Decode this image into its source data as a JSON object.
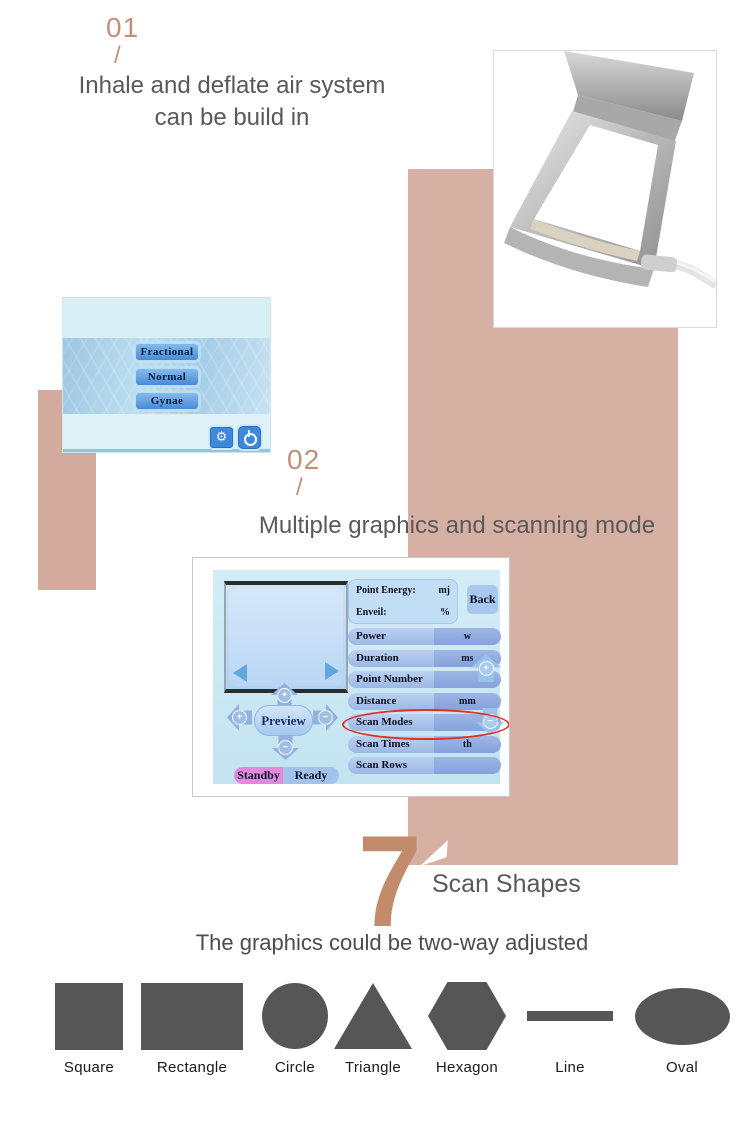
{
  "colors": {
    "accent_tan": "#d6b1a3",
    "accent_tan_left": "#d2ab9d",
    "number_tan": "#c2907a",
    "seven_tan": "#c28c6c",
    "heading_gray": "#595959",
    "shape_gray": "#565656",
    "highlight_red": "#e23023",
    "standby_pink": "#e18ade",
    "ui_blue": "#3e87da"
  },
  "section_01": {
    "number": "01",
    "slash": "/",
    "heading_line1": "Inhale and deflate air system",
    "heading_line2": "can be build in"
  },
  "device_screen": {
    "buttons": [
      "Fractional",
      "Normal",
      "Gynae"
    ],
    "gear_icon_glyph": "⚙",
    "icons": [
      "gear-icon",
      "power-icon"
    ]
  },
  "section_02": {
    "number": "02",
    "slash": "/",
    "heading": "Multiple graphics and scanning mode"
  },
  "control_screen": {
    "info_box": {
      "line1_label": "Point Energy:",
      "line1_unit": "mj",
      "line2_label": "Enveil:",
      "line2_unit": "%"
    },
    "back_button": "Back",
    "params": [
      {
        "label": "Power",
        "unit": "w"
      },
      {
        "label": "Duration",
        "unit": "ms"
      },
      {
        "label": "Point Number",
        "unit": ""
      },
      {
        "label": "Distance",
        "unit": "mm"
      },
      {
        "label": "Scan Modes",
        "unit": ""
      },
      {
        "label": "Scan Times",
        "unit": "th"
      },
      {
        "label": "Scan Rows",
        "unit": ""
      }
    ],
    "highlighted_param": "Scan Modes",
    "preview_button": "Preview",
    "standby_button": "Standby",
    "ready_button": "Ready",
    "plus": "+",
    "minus": "−"
  },
  "section_07": {
    "number": "7",
    "heading": "Scan Shapes",
    "subheading": "The graphics could be two-way adjusted"
  },
  "shapes": [
    {
      "type": "square",
      "label": "Square"
    },
    {
      "type": "rectangle",
      "label": "Rectangle"
    },
    {
      "type": "circle",
      "label": "Circle"
    },
    {
      "type": "triangle",
      "label": "Triangle"
    },
    {
      "type": "hexagon",
      "label": "Hexagon"
    },
    {
      "type": "line",
      "label": "Line"
    },
    {
      "type": "oval",
      "label": "Oval"
    }
  ]
}
